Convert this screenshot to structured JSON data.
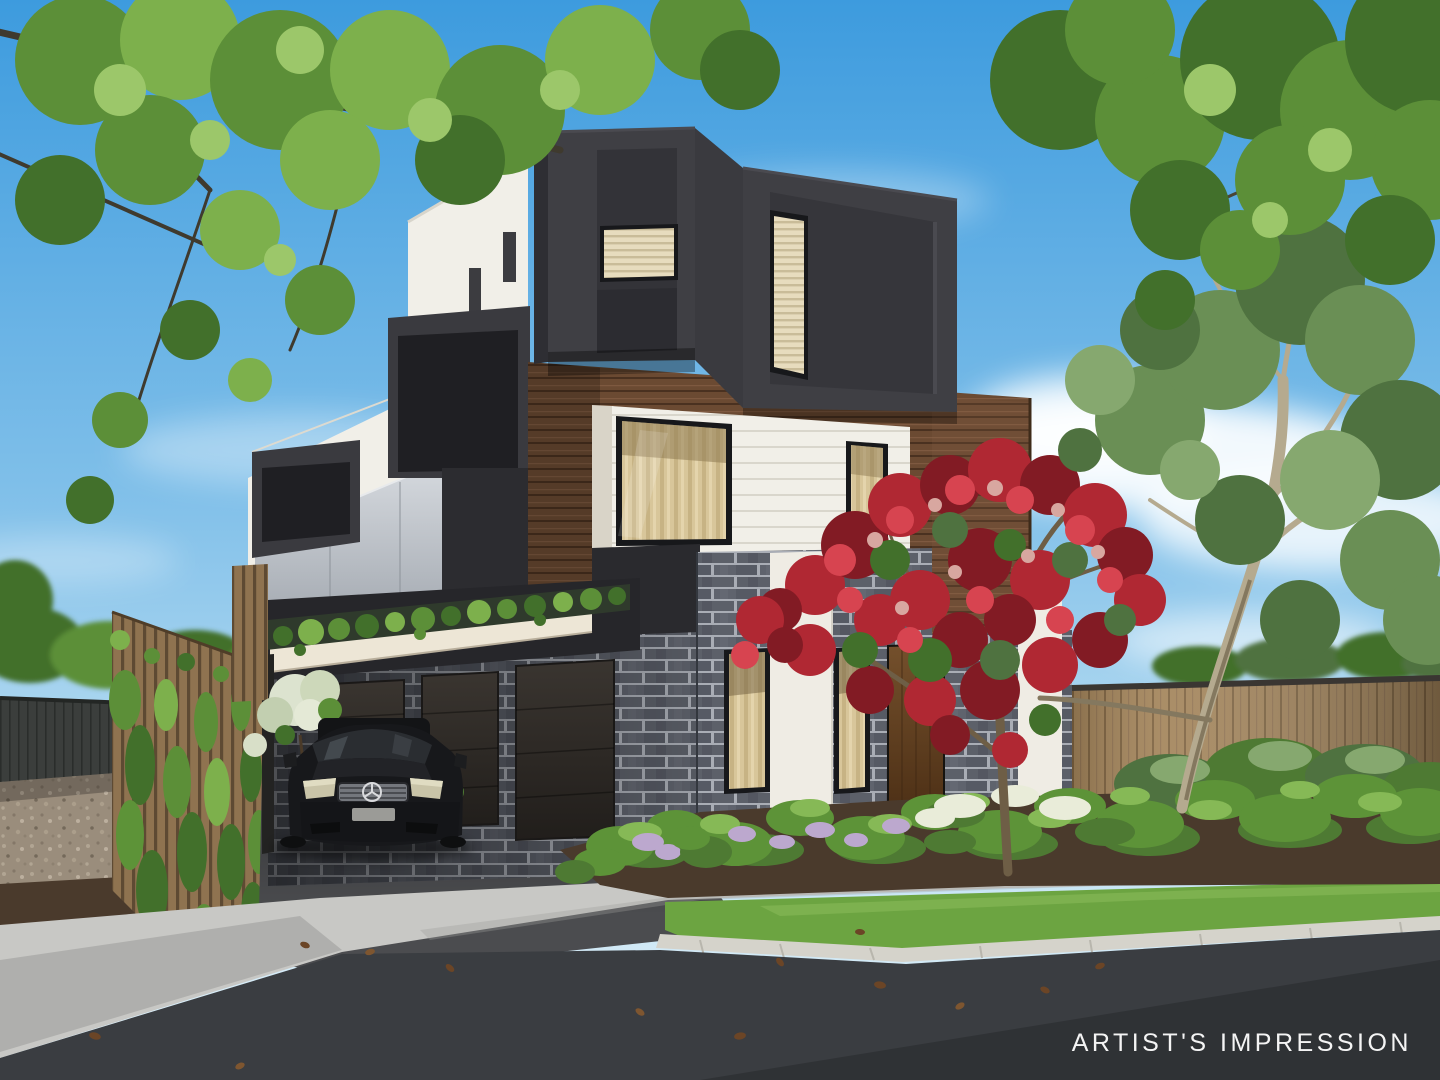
{
  "watermark": {
    "text": "ARTIST'S IMPRESSION",
    "color": "#FFFFFF"
  },
  "car": {
    "brand_icon": "mercedes-star-icon",
    "body_color": "#17181B",
    "plate_color": "#9B9B97"
  },
  "palette": {
    "sky_top": "#3D9BDE",
    "sky_mid": "#7FBFE9",
    "sky_horizon": "#E2F1F9",
    "cloud": "#FFFFFF",
    "charcoal": "#3F3F44",
    "charcoal_dark": "#2B2B2F",
    "white_cladding": "#F1EFE8",
    "cream_canopy": "#EDE6D6",
    "timber": "#6B4A32",
    "timber_dark": "#4A3120",
    "brick": "#5C6069",
    "brick_mortar": "#A9ADB5",
    "glass_warm": "#D8C69A",
    "glass_frame": "#17181B",
    "balustrade_glass": "#C2C6CB",
    "fence_timber": "#A3845A",
    "fence_dark": "#3B3E3C",
    "vine_green": "#567E36",
    "foliage_bright": "#7DB04C",
    "foliage_mid": "#5C8F38",
    "foliage_dark": "#42702B",
    "eucalyptus": "#6A8F55",
    "red_bloom": "#B02833",
    "lawn": "#6CA441",
    "gravel": "#9A8D7C",
    "mulch": "#4A3A2C",
    "asphalt_lane": "#4B4C4F",
    "road": "#3A3D41",
    "footpath": "#C8C8C5",
    "kerb": "#D5D3CB"
  }
}
